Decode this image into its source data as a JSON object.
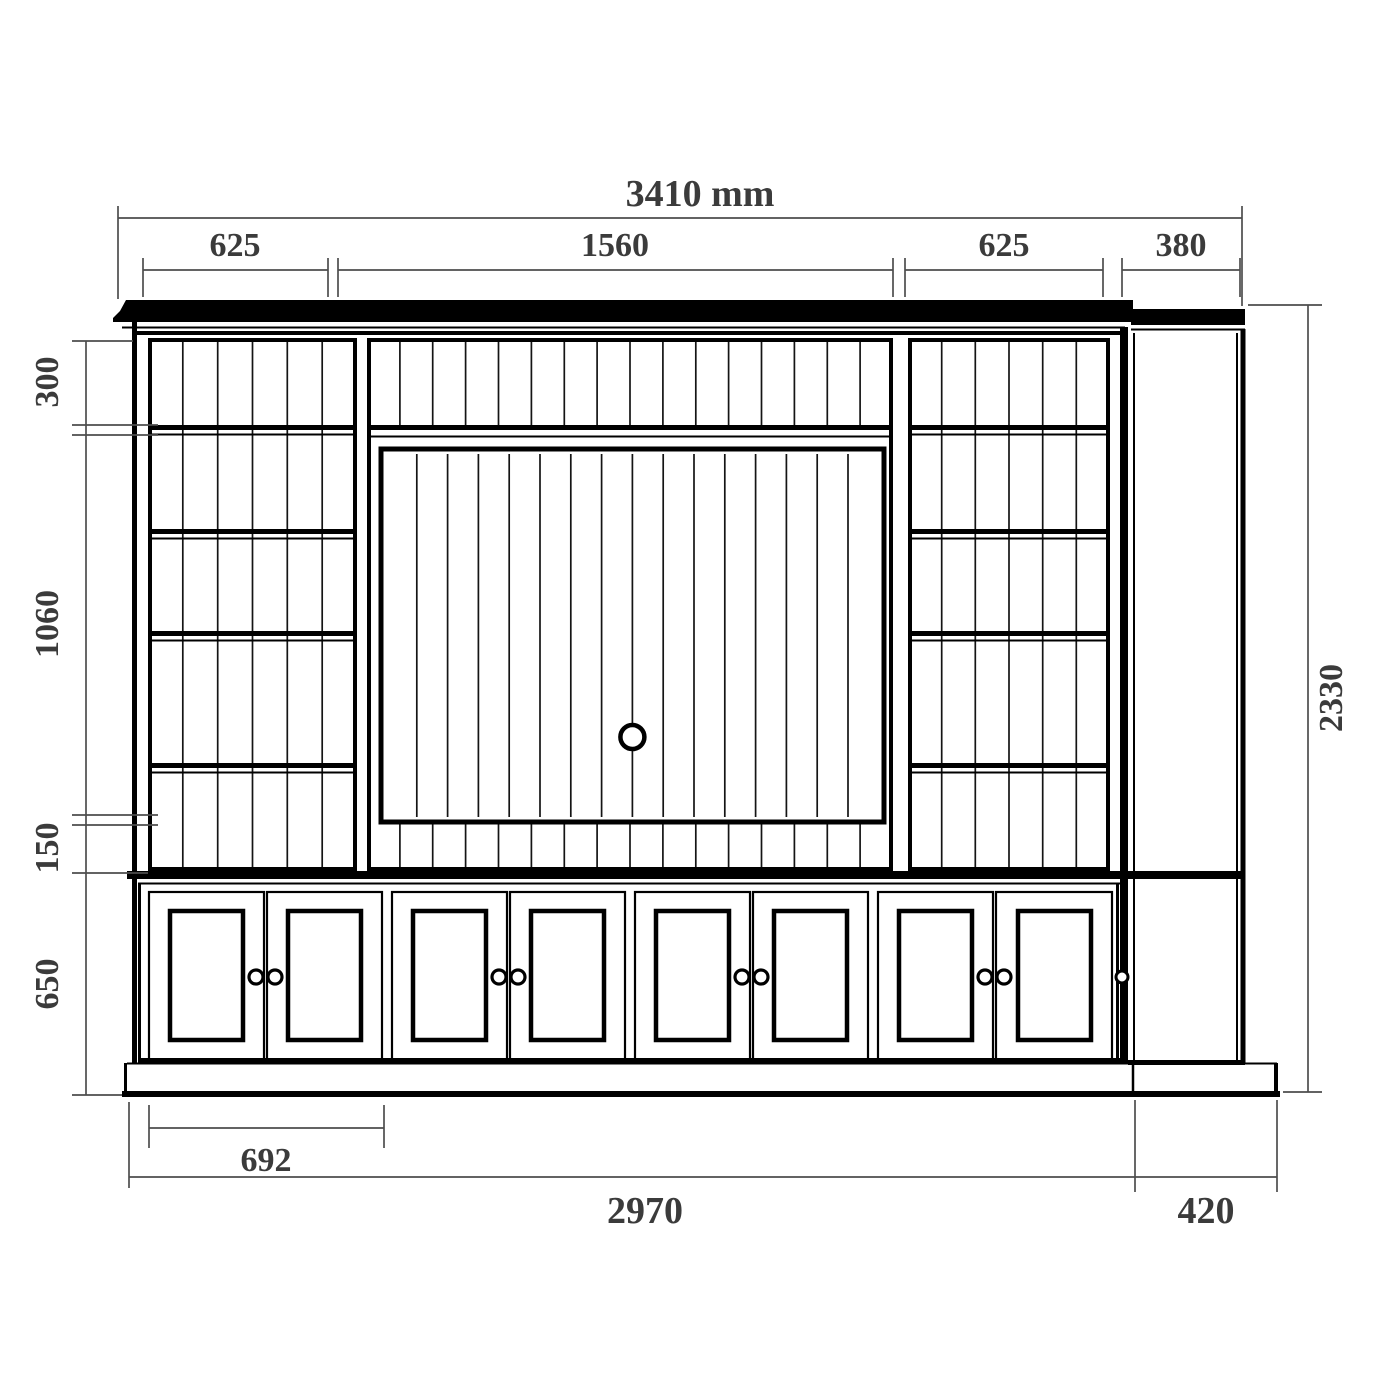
{
  "diagram": {
    "kind": "cabinet-elevation-technical-drawing",
    "unit_label": "mm",
    "dims": {
      "overall_width": "3410 mm",
      "left_bay_width": "625",
      "center_bay_width": "1560",
      "right_bay_width": "625",
      "side_return_width": "380",
      "top_section_height": "300",
      "middle_section_height": "1060",
      "gap_height": "150",
      "base_height": "650",
      "overall_height": "2330",
      "first_cabinet_width": "692",
      "main_run_width": "2970",
      "side_return_depth": "420"
    },
    "colors": {
      "line": "#000000",
      "dimension_line": "#4d4d4d",
      "dimension_text": "#3b3b3b",
      "background": "#ffffff"
    }
  }
}
